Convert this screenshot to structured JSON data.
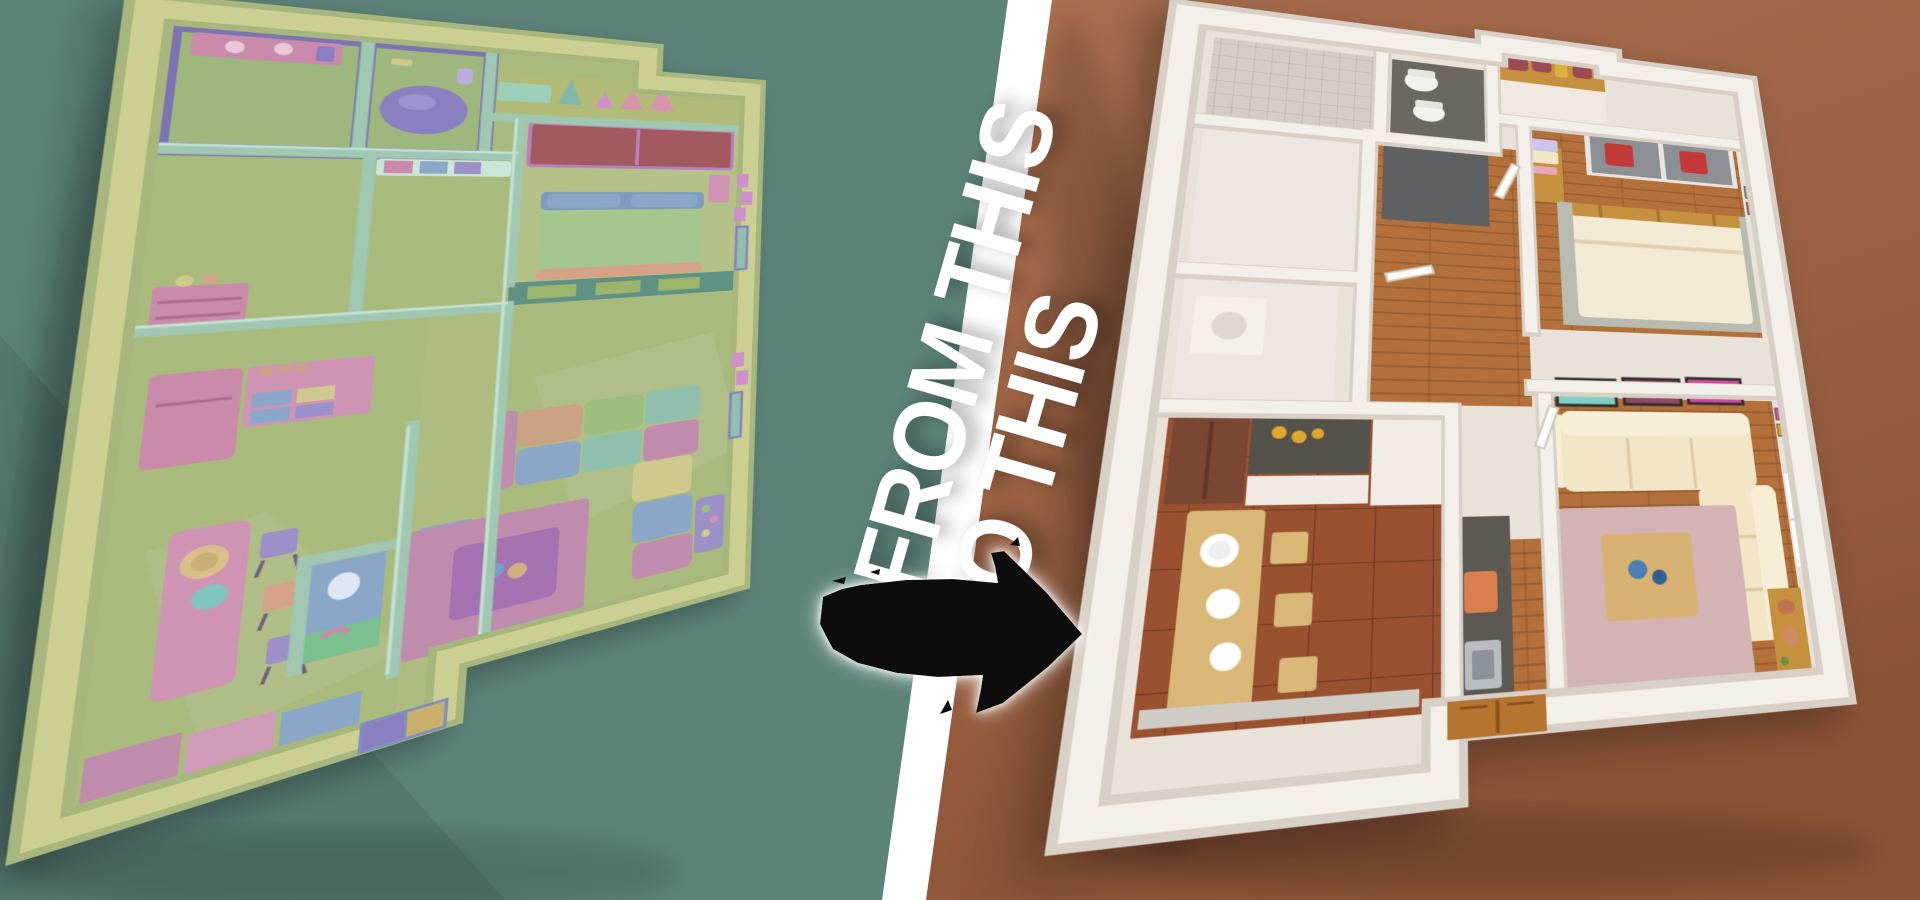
{
  "banner": {
    "from_label": "FROM THIS",
    "to_label": "TO THIS"
  },
  "divider": {
    "color": "#ffffff"
  },
  "arrow": {
    "color": "#0b0b0b",
    "glow": "#ffffff",
    "direction": "right"
  },
  "background": {
    "left": "#5c837a",
    "left_shadow": "#51746c",
    "right": "#9d6345",
    "right_light": "#a96f4f",
    "right_dark": "#8c5436"
  },
  "left_render": {
    "style": "untextured clay 3D floor plan render",
    "rooms": [
      "bathroom",
      "bathroom-with-tub",
      "closet-hallway",
      "bedroom",
      "storage-room",
      "kitchen",
      "dining-area",
      "hallway",
      "wc",
      "living-room",
      "entry"
    ],
    "palette": {
      "wall_top": "#cbcf92",
      "wall_outer": "#a6b67c",
      "floor": "#a9ba7d",
      "floor_light": "#b5c287",
      "teal_wall": "#9fc7b2",
      "teal_top": "#c9e6d6",
      "teal_dark": "#5f9184",
      "purple": "#7b74b1",
      "purple_light": "#8a7fc0",
      "pink": "#c98ba9",
      "pink_light": "#cf93b4",
      "maroon": "#a35a5e",
      "bed_green": "#a5c68c",
      "blue": "#8ba7c7",
      "teal_cushion": "#8fc0ad",
      "yellow": "#cfc98e",
      "peach": "#d5a287",
      "tan": "#c9a284",
      "lavender": "#9b90c8",
      "magenta": "#c08cae",
      "table_purple": "#a471b1",
      "window_green": "#9cb56b",
      "green_sink": "#7cbf8e",
      "art_pink": "#cf8fc9"
    }
  },
  "right_render": {
    "style": "photorealistic 3D floor plan render",
    "rooms": [
      "shower-room",
      "wc",
      "closet",
      "bedroom",
      "storage-room",
      "laundry-room",
      "hallway",
      "kitchen",
      "dining-area",
      "living-room",
      "entry"
    ],
    "palette": {
      "wall": "#f3efe9",
      "wall_shade": "#d8d0c6",
      "floor_base": "#e9e2d8",
      "wood": "#b4703a",
      "wood_dark": "#8f5426",
      "tile_terracotta": "#9a5130",
      "tile_gray": "#5f6061",
      "shower": "#d3cdc6",
      "toilet_floor": "#6b6862",
      "sofa": "#f2e6c6",
      "sofa_light": "#f7eed6",
      "rug": "#d4b3b5",
      "table_wood": "#d9b173",
      "dining_wood": "#d9b877",
      "cabinet": "#7a4733",
      "counter": "#55514b",
      "island": "#5c5852",
      "bed": "#f3ead3",
      "bed_rug": "#b8bcb0",
      "shelf_wood": "#c6913f",
      "door_wood": "#b5742f",
      "mirror": "#8c8f94",
      "red": "#c23b38",
      "box_lavender": "#cdc3ec",
      "box_cream": "#f0e6c3",
      "orange": "#d97f4e",
      "vase_blue": "#4a7fb5"
    }
  }
}
